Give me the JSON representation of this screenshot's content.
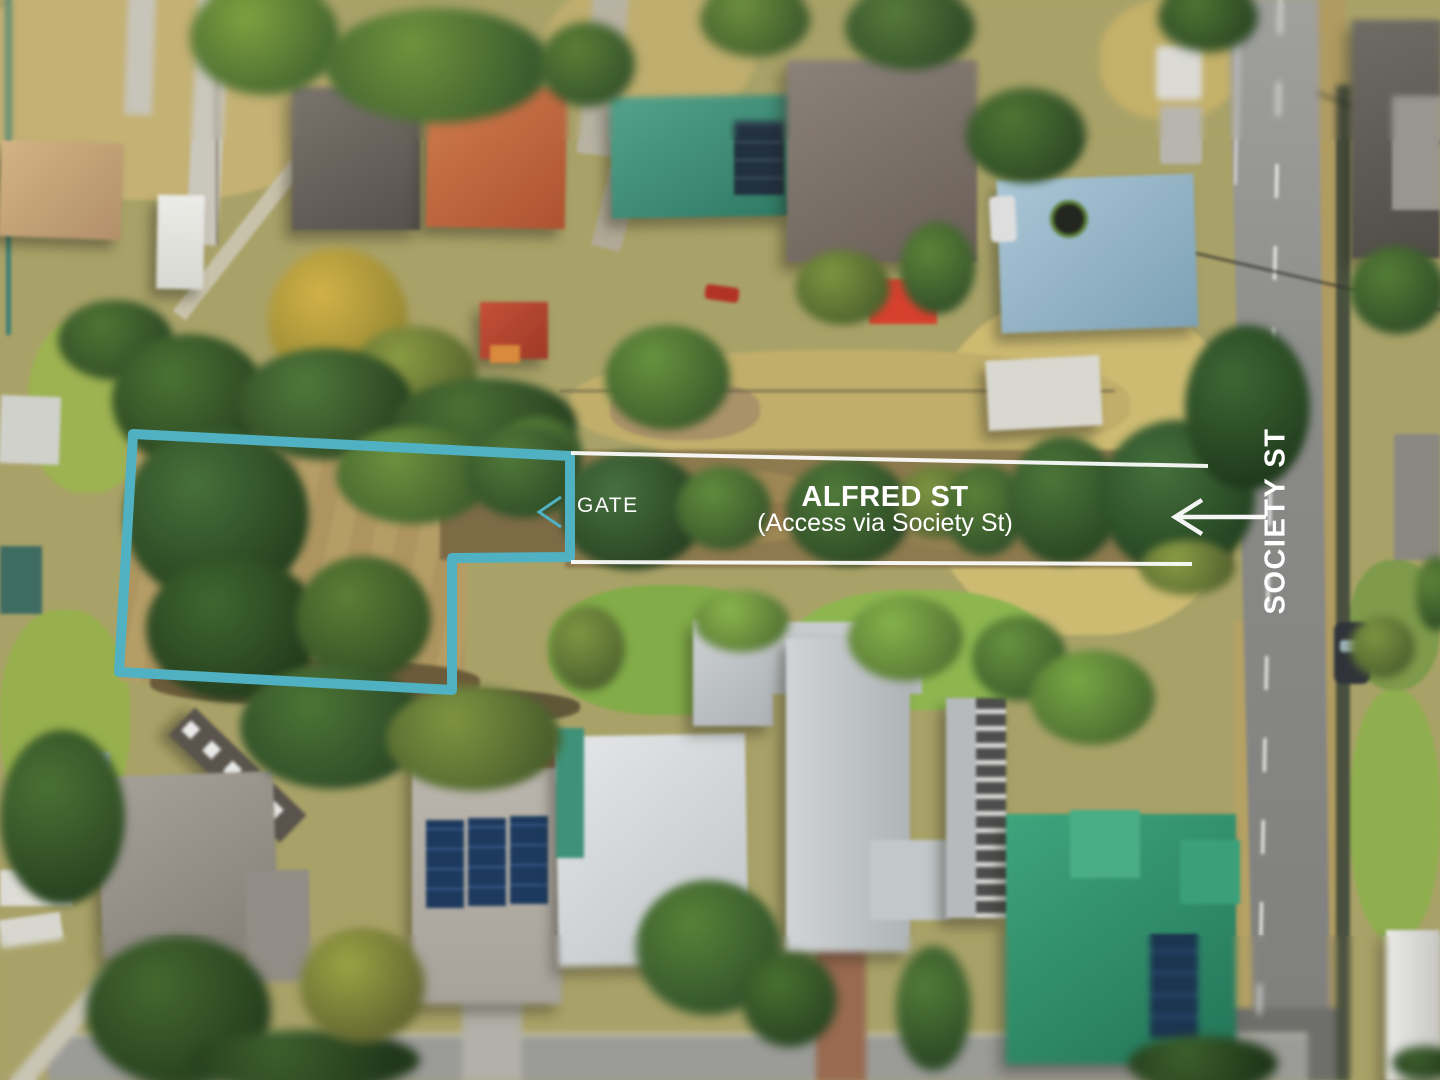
{
  "annotations": {
    "gate": {
      "label": "GATE"
    },
    "alfred_street": {
      "name": "ALFRED ST",
      "access_note": "(Access via Society St)"
    },
    "society_street": {
      "name": "SOCIETY ST"
    }
  },
  "colors": {
    "boundary": "#4FB1C1",
    "lines": "#FFFFFF"
  }
}
